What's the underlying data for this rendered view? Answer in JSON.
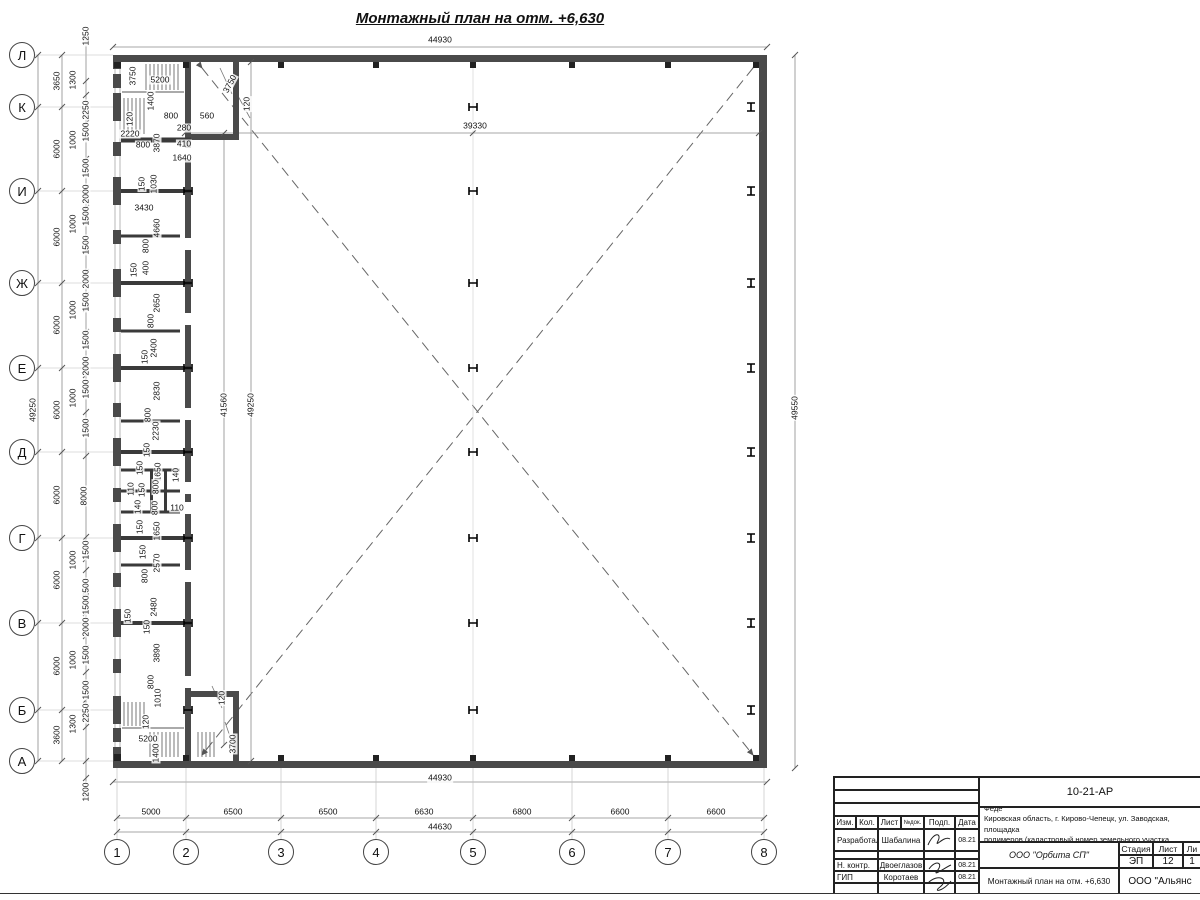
{
  "page_title": "Монтажный план на отм. +6,630",
  "axes": {
    "letters": [
      {
        "label": "Л",
        "y": 55
      },
      {
        "label": "К",
        "y": 107
      },
      {
        "label": "И",
        "y": 191
      },
      {
        "label": "Ж",
        "y": 283
      },
      {
        "label": "Е",
        "y": 368
      },
      {
        "label": "Д",
        "y": 452
      },
      {
        "label": "Г",
        "y": 538
      },
      {
        "label": "В",
        "y": 623
      },
      {
        "label": "Б",
        "y": 710
      },
      {
        "label": "А",
        "y": 761
      }
    ],
    "numbers": [
      {
        "label": "1",
        "x": 117
      },
      {
        "label": "2",
        "x": 186
      },
      {
        "label": "3",
        "x": 281
      },
      {
        "label": "4",
        "x": 376
      },
      {
        "label": "5",
        "x": 473
      },
      {
        "label": "6",
        "x": 572
      },
      {
        "label": "7",
        "x": 668
      },
      {
        "label": "8",
        "x": 764
      }
    ]
  },
  "dim_labels": [
    {
      "t": "44930",
      "x": 440,
      "y": 40,
      "r": 0
    },
    {
      "t": "3750",
      "x": 133,
      "y": 76,
      "r": 1
    },
    {
      "t": "5200",
      "x": 160,
      "y": 80,
      "r": 0
    },
    {
      "t": "1400",
      "x": 151,
      "y": 101,
      "r": 1
    },
    {
      "t": "120",
      "x": 130,
      "y": 119,
      "r": 1
    },
    {
      "t": "800",
      "x": 171,
      "y": 116,
      "r": 0
    },
    {
      "t": "280",
      "x": 184,
      "y": 128,
      "r": 0
    },
    {
      "t": "560",
      "x": 207,
      "y": 116,
      "r": 0
    },
    {
      "t": "2220",
      "x": 130,
      "y": 134,
      "r": 0
    },
    {
      "t": "800",
      "x": 143,
      "y": 145,
      "r": 0
    },
    {
      "t": "3870",
      "x": 157,
      "y": 143,
      "r": 1
    },
    {
      "t": "410",
      "x": 184,
      "y": 144,
      "r": 0
    },
    {
      "t": "1640",
      "x": 182,
      "y": 158,
      "r": 0
    },
    {
      "t": "3750",
      "x": 230,
      "y": 84,
      "r": 2
    },
    {
      "t": "120",
      "x": 247,
      "y": 104,
      "r": 1
    },
    {
      "t": "39330",
      "x": 475,
      "y": 126,
      "r": 0
    },
    {
      "t": "150",
      "x": 142,
      "y": 184,
      "r": 1
    },
    {
      "t": "1030",
      "x": 154,
      "y": 184,
      "r": 1
    },
    {
      "t": "3430",
      "x": 144,
      "y": 208,
      "r": 0
    },
    {
      "t": "4660",
      "x": 157,
      "y": 228,
      "r": 1
    },
    {
      "t": "800",
      "x": 146,
      "y": 246,
      "r": 1
    },
    {
      "t": "400",
      "x": 146,
      "y": 268,
      "r": 1
    },
    {
      "t": "150",
      "x": 134,
      "y": 270,
      "r": 1
    },
    {
      "t": "2650",
      "x": 157,
      "y": 303,
      "r": 1
    },
    {
      "t": "800",
      "x": 151,
      "y": 321,
      "r": 1
    },
    {
      "t": "2400",
      "x": 154,
      "y": 348,
      "r": 1
    },
    {
      "t": "150",
      "x": 145,
      "y": 357,
      "r": 1
    },
    {
      "t": "2830",
      "x": 157,
      "y": 391,
      "r": 1
    },
    {
      "t": "800",
      "x": 148,
      "y": 415,
      "r": 1
    },
    {
      "t": "2230",
      "x": 156,
      "y": 431,
      "r": 1
    },
    {
      "t": "150",
      "x": 147,
      "y": 450,
      "r": 1
    },
    {
      "t": "150",
      "x": 140,
      "y": 468,
      "r": 1
    },
    {
      "t": "1650",
      "x": 158,
      "y": 472,
      "r": 1
    },
    {
      "t": "140",
      "x": 176,
      "y": 475,
      "r": 1
    },
    {
      "t": "110",
      "x": 131,
      "y": 489,
      "r": 1
    },
    {
      "t": "150",
      "x": 142,
      "y": 490,
      "r": 1
    },
    {
      "t": "800",
      "x": 156,
      "y": 487,
      "r": 1
    },
    {
      "t": "140",
      "x": 138,
      "y": 507,
      "r": 1
    },
    {
      "t": "800",
      "x": 155,
      "y": 508,
      "r": 1
    },
    {
      "t": "110",
      "x": 177,
      "y": 508,
      "r": 0
    },
    {
      "t": "150",
      "x": 140,
      "y": 527,
      "r": 1
    },
    {
      "t": "1650",
      "x": 157,
      "y": 531,
      "r": 1
    },
    {
      "t": "150",
      "x": 143,
      "y": 552,
      "r": 1
    },
    {
      "t": "2570",
      "x": 157,
      "y": 563,
      "r": 1
    },
    {
      "t": "800",
      "x": 145,
      "y": 576,
      "r": 1
    },
    {
      "t": "2480",
      "x": 154,
      "y": 607,
      "r": 1
    },
    {
      "t": "150",
      "x": 128,
      "y": 616,
      "r": 1
    },
    {
      "t": "150",
      "x": 147,
      "y": 627,
      "r": 1
    },
    {
      "t": "3890",
      "x": 157,
      "y": 653,
      "r": 1
    },
    {
      "t": "800",
      "x": 151,
      "y": 682,
      "r": 1
    },
    {
      "t": "1010",
      "x": 158,
      "y": 698,
      "r": 1
    },
    {
      "t": "120",
      "x": 146,
      "y": 722,
      "r": 1
    },
    {
      "t": "5200",
      "x": 148,
      "y": 739,
      "r": 0
    },
    {
      "t": "1400",
      "x": 156,
      "y": 753,
      "r": 1
    },
    {
      "t": "120",
      "x": 222,
      "y": 698,
      "r": 1
    },
    {
      "t": "3700",
      "x": 233,
      "y": 744,
      "r": 1
    },
    {
      "t": "41560",
      "x": 224,
      "y": 405,
      "r": 1
    },
    {
      "t": "49250",
      "x": 251,
      "y": 405,
      "r": 1
    },
    {
      "t": "49550",
      "x": 795,
      "y": 408,
      "r": 1
    },
    {
      "t": "49250",
      "x": 33,
      "y": 410,
      "r": 1
    },
    {
      "t": "3650",
      "x": 57,
      "y": 81,
      "r": 1
    },
    {
      "t": "6000",
      "x": 57,
      "y": 149,
      "r": 1
    },
    {
      "t": "6000",
      "x": 57,
      "y": 237,
      "r": 1
    },
    {
      "t": "6000",
      "x": 57,
      "y": 325,
      "r": 1
    },
    {
      "t": "6000",
      "x": 57,
      "y": 410,
      "r": 1
    },
    {
      "t": "6000",
      "x": 57,
      "y": 495,
      "r": 1
    },
    {
      "t": "6000",
      "x": 57,
      "y": 580,
      "r": 1
    },
    {
      "t": "6000",
      "x": 57,
      "y": 666,
      "r": 1
    },
    {
      "t": "3600",
      "x": 57,
      "y": 735,
      "r": 1
    },
    {
      "t": "1250",
      "x": 86,
      "y": 36,
      "r": 1
    },
    {
      "t": "2250",
      "x": 86,
      "y": 110,
      "r": 1
    },
    {
      "t": "1500",
      "x": 86,
      "y": 132,
      "r": 1
    },
    {
      "t": "1500",
      "x": 86,
      "y": 168,
      "r": 1
    },
    {
      "t": "2000",
      "x": 86,
      "y": 194,
      "r": 1
    },
    {
      "t": "1500",
      "x": 86,
      "y": 216,
      "r": 1
    },
    {
      "t": "1500",
      "x": 86,
      "y": 245,
      "r": 1
    },
    {
      "t": "2000",
      "x": 86,
      "y": 279,
      "r": 1
    },
    {
      "t": "1500",
      "x": 86,
      "y": 302,
      "r": 1
    },
    {
      "t": "1500",
      "x": 86,
      "y": 340,
      "r": 1
    },
    {
      "t": "2000",
      "x": 86,
      "y": 366,
      "r": 1
    },
    {
      "t": "1500",
      "x": 86,
      "y": 389,
      "r": 1
    },
    {
      "t": "1500",
      "x": 86,
      "y": 428,
      "r": 1
    },
    {
      "t": "8000",
      "x": 84,
      "y": 496,
      "r": 1
    },
    {
      "t": "1500",
      "x": 86,
      "y": 550,
      "r": 1
    },
    {
      "t": "1500",
      "x": 86,
      "y": 588,
      "r": 1
    },
    {
      "t": "1500",
      "x": 86,
      "y": 605,
      "r": 1
    },
    {
      "t": "2000",
      "x": 86,
      "y": 627,
      "r": 1
    },
    {
      "t": "1500",
      "x": 86,
      "y": 655,
      "r": 1
    },
    {
      "t": "1500",
      "x": 86,
      "y": 690,
      "r": 1
    },
    {
      "t": "2250",
      "x": 86,
      "y": 713,
      "r": 1
    },
    {
      "t": "1200",
      "x": 86,
      "y": 792,
      "r": 1
    },
    {
      "t": "1300",
      "x": 73,
      "y": 80,
      "r": 1
    },
    {
      "t": "1000",
      "x": 73,
      "y": 140,
      "r": 1
    },
    {
      "t": "1000",
      "x": 73,
      "y": 224,
      "r": 1
    },
    {
      "t": "1000",
      "x": 73,
      "y": 310,
      "r": 1
    },
    {
      "t": "1000",
      "x": 73,
      "y": 398,
      "r": 1
    },
    {
      "t": "1000",
      "x": 73,
      "y": 560,
      "r": 1
    },
    {
      "t": "1000",
      "x": 73,
      "y": 660,
      "r": 1
    },
    {
      "t": "1300",
      "x": 73,
      "y": 724,
      "r": 1
    },
    {
      "t": "44930",
      "x": 440,
      "y": 778,
      "r": 0
    },
    {
      "t": "5000",
      "x": 151,
      "y": 812,
      "r": 0
    },
    {
      "t": "6500",
      "x": 233,
      "y": 812,
      "r": 0
    },
    {
      "t": "6500",
      "x": 328,
      "y": 812,
      "r": 0
    },
    {
      "t": "6630",
      "x": 424,
      "y": 812,
      "r": 0
    },
    {
      "t": "6800",
      "x": 522,
      "y": 812,
      "r": 0
    },
    {
      "t": "6600",
      "x": 620,
      "y": 812,
      "r": 0
    },
    {
      "t": "6600",
      "x": 716,
      "y": 812,
      "r": 0
    },
    {
      "t": "44630",
      "x": 440,
      "y": 827,
      "r": 0
    }
  ],
  "title_block": {
    "code": "10-21-АР",
    "desc_line1": "Здание склада АБК, расположенное по адресу: Российская Феде",
    "desc_line2": "Кировская область, г. Кирово-Чепецк, ул. Заводская, площадка",
    "desc_line3": "полимеров (кадастровый номер земельного участка 43:42:0000",
    "col_headers": [
      "Изм.",
      "Кол.",
      "Лист",
      "№док.",
      "Подп.",
      "Дата"
    ],
    "rows": [
      {
        "role": "Разработал",
        "name": "Шабалина",
        "date": "08.21"
      },
      {
        "role": "Н. контр.",
        "name": "Двоеглазов",
        "date": "08.21"
      },
      {
        "role": "ГИП",
        "name": "Коротаев",
        "date": "08.21"
      }
    ],
    "org": "ООО \"Орбита СП\"",
    "stage_label": "Стадия",
    "sheet_label": "Лист",
    "sheets_label": "Ли",
    "stage": "ЭП",
    "sheet": "12",
    "sheets": "1",
    "drawing_title": "Монтажный план на отм. +6,630",
    "company": "ООО \"Альянс"
  }
}
